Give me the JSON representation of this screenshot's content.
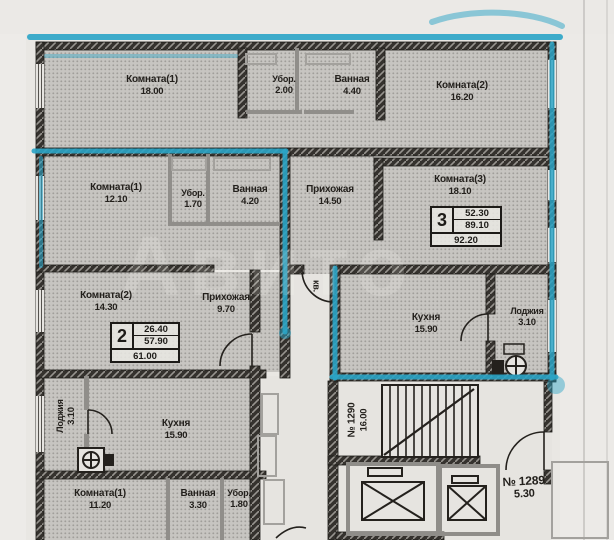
{
  "plan": {
    "watermark": "Авито",
    "colors": {
      "highlight": "#2aa4c6",
      "wall": "#35322e",
      "room_fill": "#bcbab6",
      "paper": "#e9e7e3"
    },
    "apartments": {
      "top": {
        "room1": {
          "name": "Комната(1)",
          "area": "18.00"
        },
        "wc": {
          "name": "Убор.",
          "area": "2.00"
        },
        "bath": {
          "name": "Ванная",
          "area": "4.40"
        },
        "room2": {
          "name": "Комната(2)",
          "area": "16.20"
        }
      },
      "two_room": {
        "room1": {
          "name": "Комната(1)",
          "area": "12.10"
        },
        "wc": {
          "name": "Убор.",
          "area": "1.70"
        },
        "bath": {
          "name": "Ванная",
          "area": "4.20"
        },
        "room2": {
          "name": "Комната(2)",
          "area": "14.30"
        },
        "hall": {
          "name": "Прихожая",
          "area": "9.70"
        },
        "stamp": {
          "number": "2",
          "living": "26.40",
          "aux": "57.90",
          "total": "61.00"
        }
      },
      "three_room": {
        "hall": {
          "name": "Прихожая",
          "area": "14.50"
        },
        "room3": {
          "name": "Комната(3)",
          "area": "18.10"
        },
        "kitchen": {
          "name": "Кухня",
          "area": "15.90"
        },
        "loggia": {
          "name": "Лоджия",
          "area": "3.10"
        },
        "stamp": {
          "number": "3",
          "living": "52.30",
          "aux": "89.10",
          "total": "92.20"
        }
      },
      "one_room": {
        "loggia": {
          "name": "Лоджия",
          "area": "3.10"
        },
        "kitchen": {
          "name": "Кухня",
          "area": "15.90"
        },
        "room1": {
          "name": "Комната(1)",
          "area": "11.20"
        },
        "bath": {
          "name": "Ванная",
          "area": "3.30"
        },
        "wc": {
          "name": "Убор.",
          "area": "1.80"
        }
      }
    },
    "common": {
      "stairwell": {
        "number": "№ 1290",
        "area": "16.00"
      },
      "corridor": {
        "number": "№ 1289",
        "area": "5.30"
      },
      "entrance_label": "кв."
    }
  }
}
